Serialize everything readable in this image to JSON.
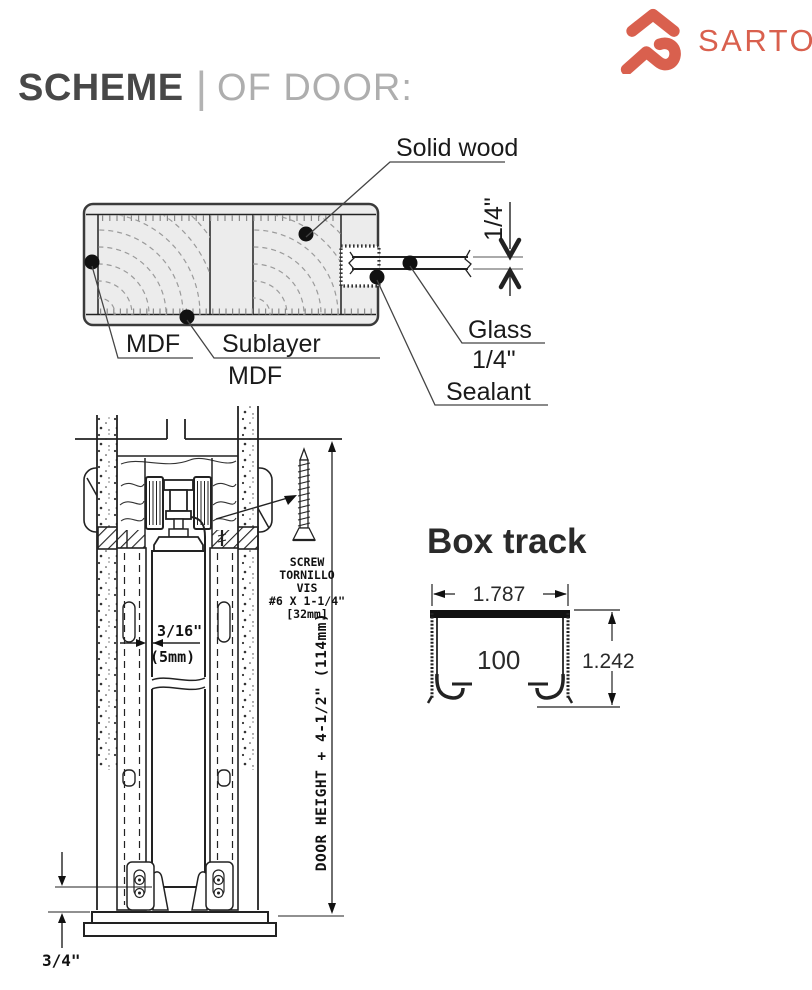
{
  "header": {
    "main": "SCHEME",
    "separator": "|",
    "sub": "OF DOOR:"
  },
  "logo": {
    "text": "SARTO"
  },
  "cross_section": {
    "labels": {
      "solid_wood": "Solid wood",
      "mdf": "MDF",
      "sublayer_l1": "Sublayer",
      "sublayer_l2": "MDF",
      "glass_l1": "Glass",
      "glass_l2": "1/4\"",
      "sealant": "Sealant",
      "thickness_dim": "1/4\""
    }
  },
  "track": {
    "screw_lines": [
      "SCREW",
      "TORNILLO",
      "VIS",
      "#6 X 1-1/4\"",
      "[32mm]"
    ],
    "gap_l1": "3/16\"",
    "gap_l2": "(5mm)",
    "height_dim": "DOOR HEIGHT + 4-1/2\" (114mm)",
    "floor_dim": "3/4\""
  },
  "box_track": {
    "title": "Box track",
    "width_dim": "1.787",
    "inner_label": "100",
    "height_dim": "1.242"
  },
  "colors": {
    "accent": "#d9604e",
    "ink": "#222222",
    "panel_fill": "#ececec",
    "grain": "#9b9b9b"
  }
}
